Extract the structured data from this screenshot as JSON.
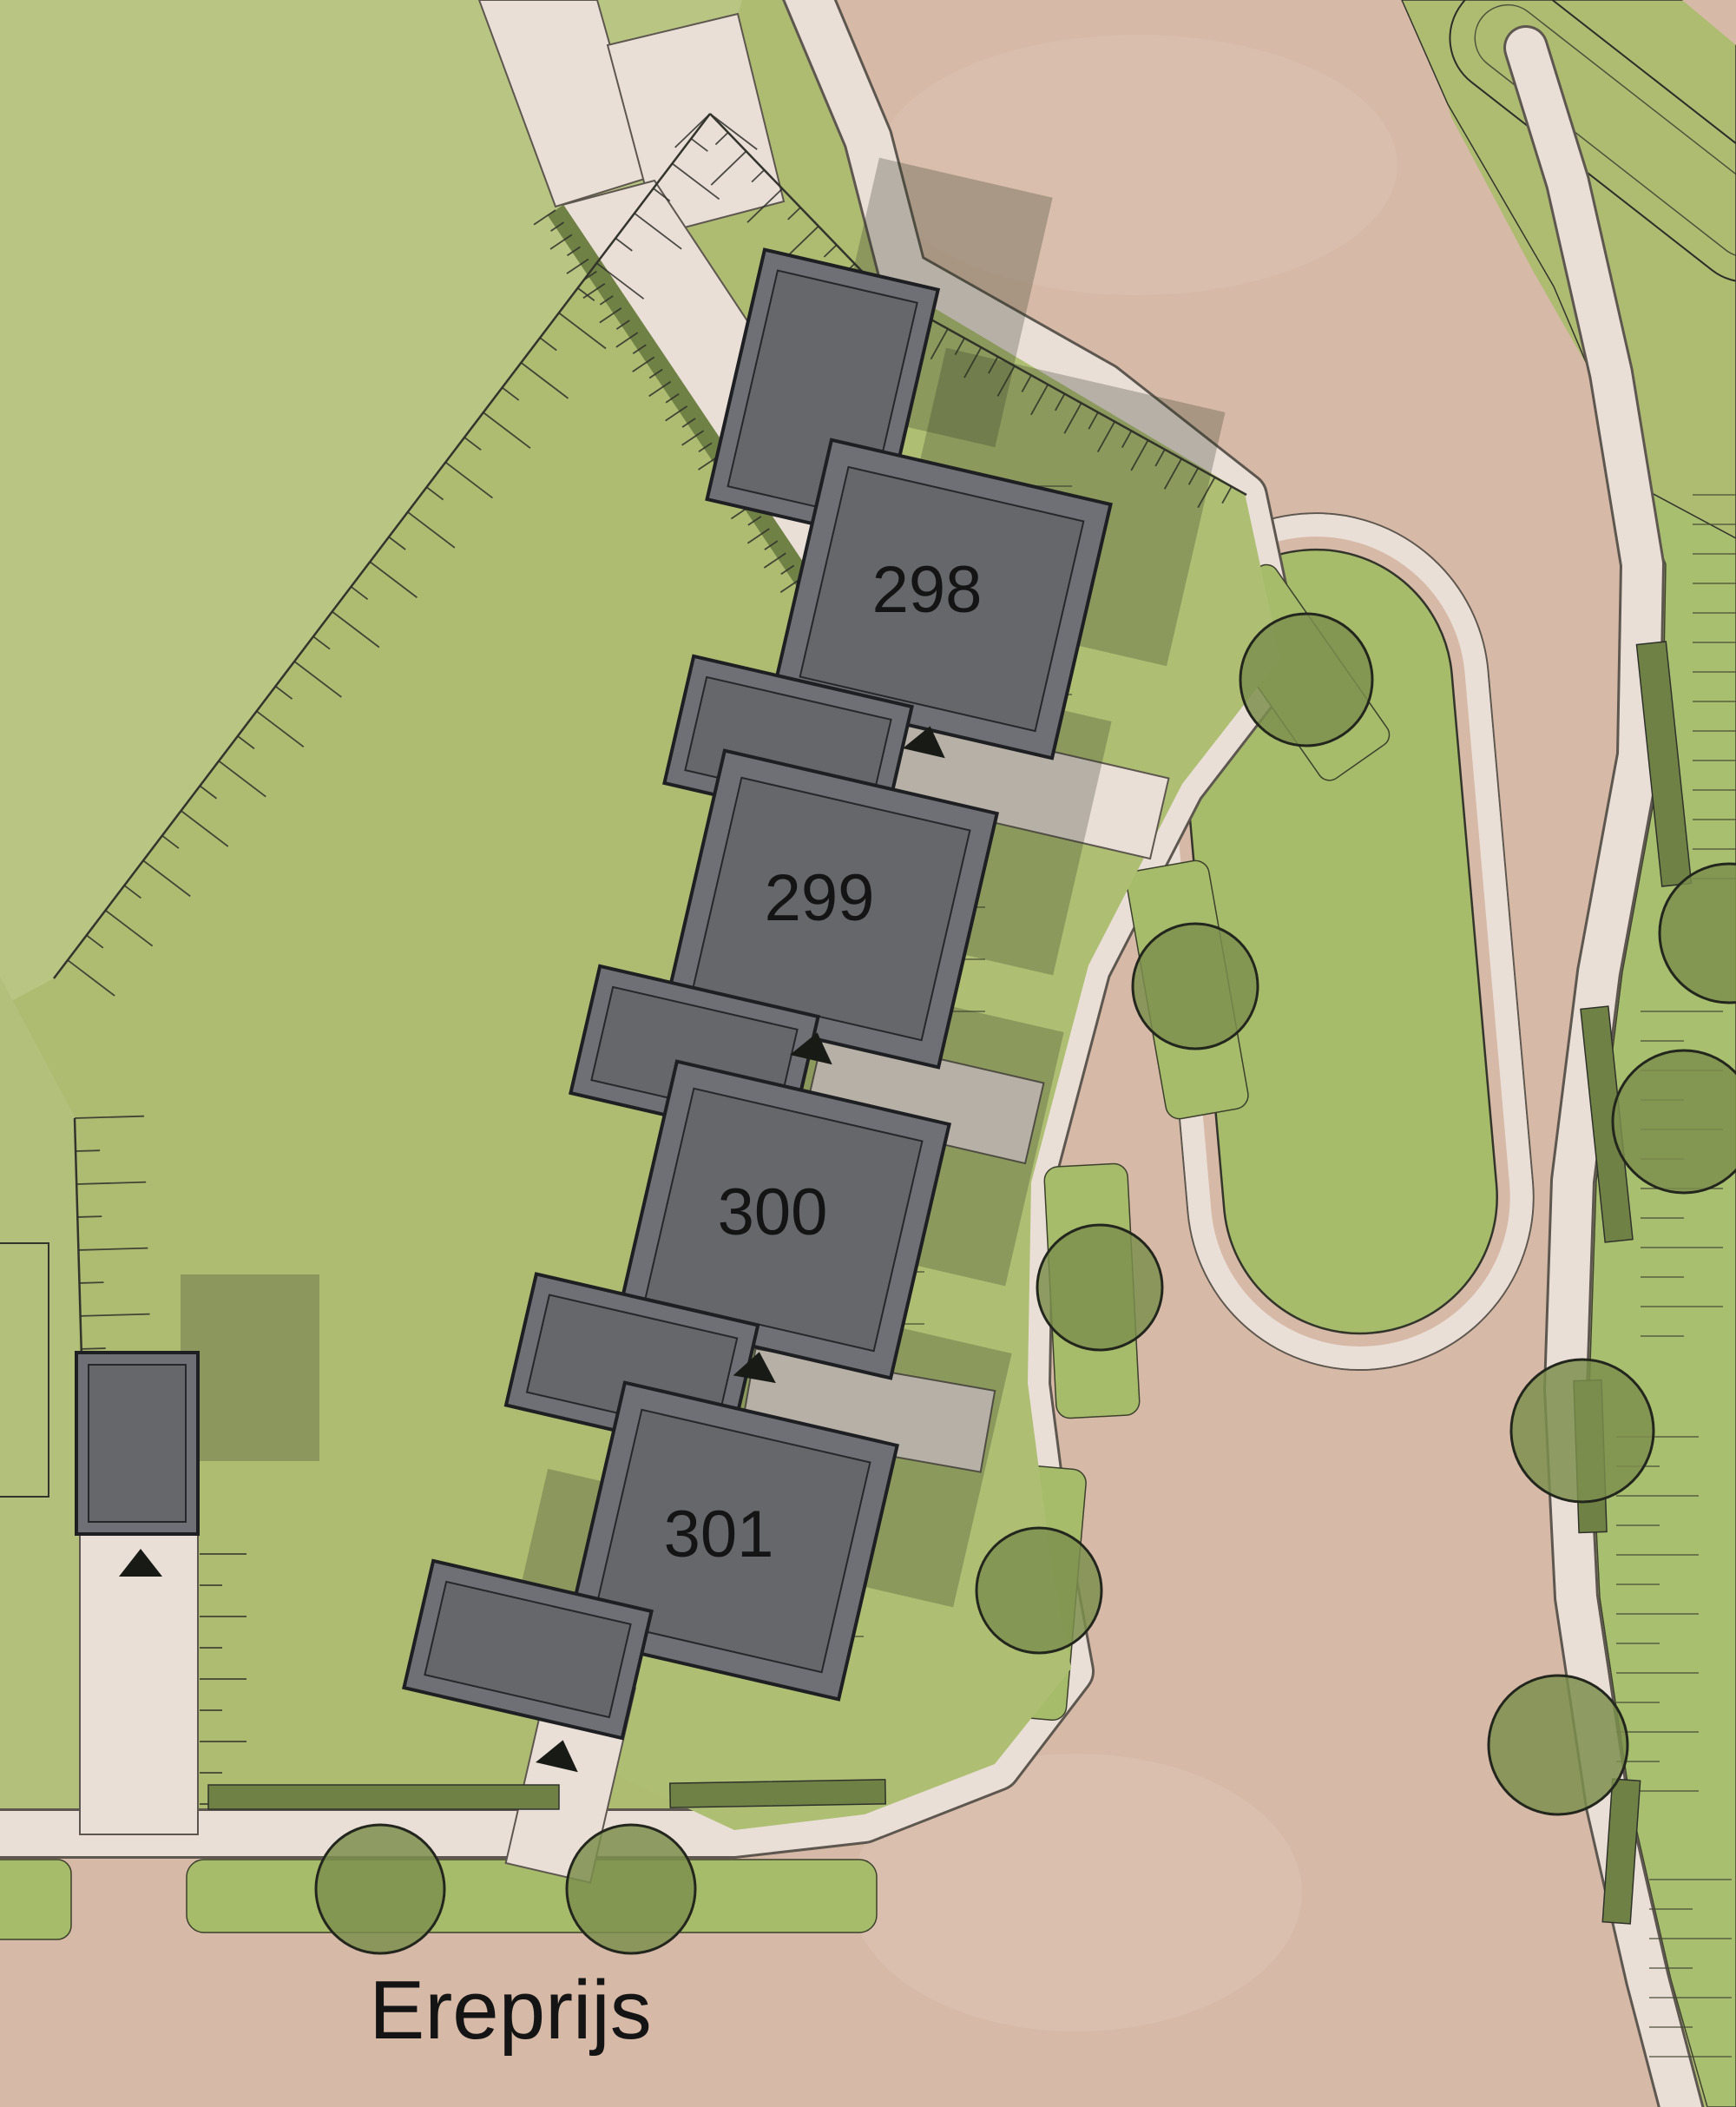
{
  "street": {
    "name": "Ereprijs"
  },
  "buildings": [
    {
      "label": "298"
    },
    {
      "label": "299"
    },
    {
      "label": "300"
    },
    {
      "label": "301"
    }
  ],
  "icons": {
    "entrance_arrow": "triangle-up",
    "tree": "circle"
  },
  "palette": {
    "grass": "#aebc72",
    "grass-light": "#b9c583",
    "grass-left": "#b3c07c",
    "garden": "#aebf74",
    "verge": "#a6bc6b",
    "hedge": "#708146",
    "tree": "#7c8f4e",
    "tree-edge": "#23261c",
    "road": "#d6b9a7",
    "path": "#eadfd7",
    "path-edge": "#5d574f",
    "line": "#33342c",
    "building": "#6e7075",
    "building-inner": "#65676b",
    "building-edge": "#1e1f22",
    "shadow": "#2e3423",
    "label": "#141414"
  }
}
